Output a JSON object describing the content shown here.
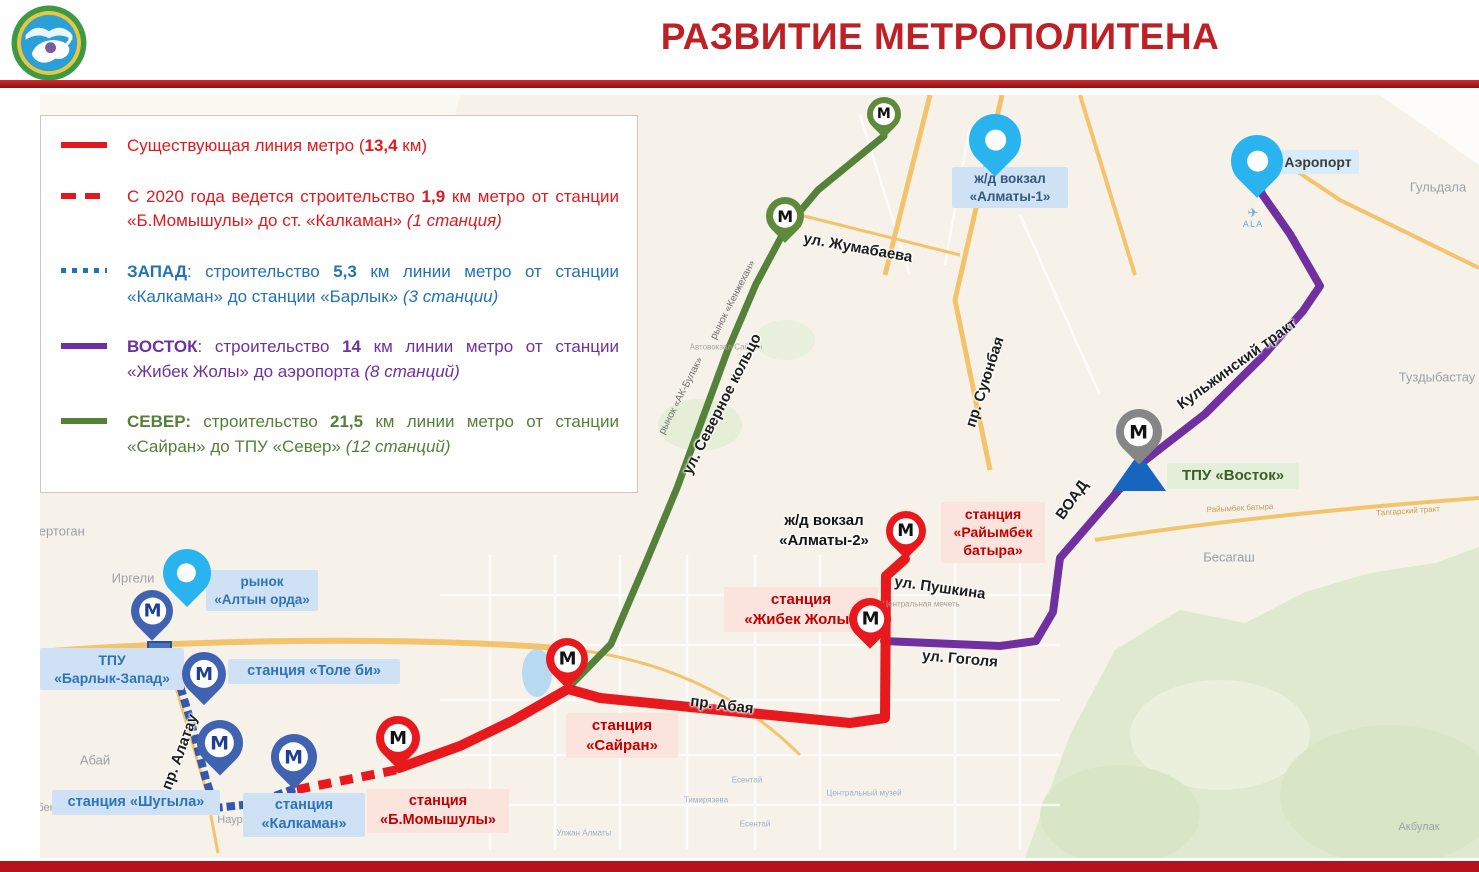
{
  "meta": {
    "width": 1479,
    "height": 872
  },
  "header": {
    "title": "РАЗВИТИЕ МЕТРОПОЛИТЕНА"
  },
  "palette": {
    "title_red": "#bf2025",
    "rule_red": "#a3141a",
    "footer_red": "#b5121b",
    "existing_red": "#e8191d",
    "west_blue": "#2e74b5",
    "east_purple": "#7030a0",
    "north_green": "#538135",
    "pink_box": "#fbe3de",
    "pink_text": "#c00000",
    "blue_box": "#cfe2f5",
    "blue_text": "#2e74b5",
    "green_box": "#e3efd9",
    "green_text": "#3a5f27",
    "cyan_pin": "#29b4ef",
    "blue_pin": "#3f63b0",
    "red_pin": "#e8191d",
    "green_pin": "#5d8a3b",
    "gray_pin": "#868686",
    "map_bg": "#f6f1e9"
  },
  "legend": {
    "items": [
      {
        "id": "existing",
        "swatch": "solid",
        "color": "#e2191c",
        "runs": [
          {
            "t": "Существующая линия метро (",
            "s": "n"
          },
          {
            "t": "13,4",
            "s": "b"
          },
          {
            "t": " км)",
            "s": "n"
          }
        ]
      },
      {
        "id": "construction-2020",
        "swatch": "dashed",
        "color": "#e2191c",
        "runs": [
          {
            "t": "С 2020 года ведется строительство ",
            "s": "n"
          },
          {
            "t": "1,9",
            "s": "b"
          },
          {
            "t": " км метро от станции «Б.Момышулы»  до ст. «Калкаман» ",
            "s": "n"
          },
          {
            "t": "(1 станция)",
            "s": "i"
          }
        ]
      },
      {
        "id": "west",
        "swatch": "dotted",
        "color": "#2272b8",
        "runs": [
          {
            "t": "ЗАПАД",
            "s": "b"
          },
          {
            "t": ": строительство ",
            "s": "n"
          },
          {
            "t": "5,3",
            "s": "b"
          },
          {
            "t": " км линии метро от станции «Калкаман» до станции «Барлык» ",
            "s": "n"
          },
          {
            "t": "(3 станции)",
            "s": "i"
          }
        ]
      },
      {
        "id": "east",
        "swatch": "solid",
        "color": "#7030a0",
        "runs": [
          {
            "t": "ВОСТОК",
            "s": "b"
          },
          {
            "t": ": строительство ",
            "s": "n"
          },
          {
            "t": "14",
            "s": "b"
          },
          {
            "t": " км линии метро от станции «Жибек Жолы» до аэропорта  ",
            "s": "n"
          },
          {
            "t": "(8 станций)",
            "s": "i"
          }
        ]
      },
      {
        "id": "north",
        "swatch": "solid",
        "color": "#538135",
        "runs": [
          {
            "t": "СЕВЕР:",
            "s": "b"
          },
          {
            "t": " строительство ",
            "s": "n"
          },
          {
            "t": "21,5",
            "s": "b"
          },
          {
            "t": " км линии метро от станции «Сайран» до ТПУ «Север» ",
            "s": "n"
          },
          {
            "t": "(12 станций)",
            "s": "i"
          }
        ]
      }
    ]
  },
  "map": {
    "airport_code": "ALA",
    "lines": [
      {
        "id": "north-line",
        "color": "#55823a",
        "width": 7,
        "cap": "round",
        "points": [
          [
            884,
            136
          ],
          [
            818,
            190
          ],
          [
            786,
            228
          ],
          [
            756,
            284
          ],
          [
            727,
            352
          ],
          [
            702,
            420
          ],
          [
            677,
            488
          ],
          [
            647,
            560
          ],
          [
            611,
            644
          ],
          [
            568,
            688
          ]
        ]
      },
      {
        "id": "east-line",
        "color": "#7030a0",
        "width": 8,
        "cap": "round",
        "points": [
          [
            884,
            641
          ],
          [
            1000,
            646
          ],
          [
            1036,
            641
          ],
          [
            1053,
            612
          ],
          [
            1060,
            558
          ],
          [
            1143,
            462
          ],
          [
            1205,
            414
          ],
          [
            1262,
            357
          ],
          [
            1303,
            311
          ],
          [
            1320,
            286
          ],
          [
            1290,
            234
          ],
          [
            1262,
            194
          ],
          [
            1256,
            179
          ]
        ]
      },
      {
        "id": "existing-line",
        "color": "#e8191d",
        "width": 10,
        "cap": "round",
        "points": [
          [
            905,
            559
          ],
          [
            886,
            576
          ],
          [
            885,
            718
          ],
          [
            850,
            723
          ],
          [
            700,
            708
          ],
          [
            600,
            698
          ],
          [
            568,
            689
          ],
          [
            512,
            721
          ],
          [
            460,
            746
          ],
          [
            424,
            759
          ],
          [
            399,
            768
          ]
        ]
      },
      {
        "id": "construction-2020-line",
        "color": "#e8191d",
        "width": 9,
        "dash": "13 9",
        "cap": "butt",
        "points": [
          [
            396,
            770
          ],
          [
            295,
            790
          ]
        ]
      },
      {
        "id": "west-line",
        "color": "#3558ae",
        "width": 8,
        "dash": "0.5 12",
        "cap": "square",
        "points": [
          [
            291,
            790
          ],
          [
            252,
            804
          ],
          [
            215,
            808
          ],
          [
            205,
            776
          ],
          [
            191,
            722
          ],
          [
            177,
            676
          ],
          [
            163,
            653
          ]
        ]
      }
    ],
    "station_labels": [
      {
        "id": "railway-almaty1",
        "style": "navy",
        "x": 952,
        "y": 167,
        "w": 104,
        "fs": 13.5,
        "lines": [
          "ж/д вокзал",
          "«Алматы-1»"
        ]
      },
      {
        "id": "airport",
        "style": "lightblue",
        "x": 1277,
        "y": 150,
        "w": 70,
        "fs": 14,
        "lines": [
          "Аэропорт"
        ]
      },
      {
        "id": "rynok-altyn-orda",
        "style": "blue",
        "x": 206,
        "y": 570,
        "w": 100,
        "fs": 13.5,
        "lines": [
          "рынок",
          "«Алтын орда»"
        ]
      },
      {
        "id": "tpu-barlyk-zapad",
        "style": "blue",
        "x": 40,
        "y": 648,
        "w": 132,
        "fs": 14,
        "lines": [
          "ТПУ",
          "«Барлык-Запад»"
        ]
      },
      {
        "id": "tole-bi",
        "style": "blue",
        "x": 228,
        "y": 659,
        "w": 160,
        "fs": 14.5,
        "lines": [
          "станция  «Толе би»"
        ]
      },
      {
        "id": "shugyla",
        "style": "blue",
        "x": 52,
        "y": 790,
        "w": 156,
        "fs": 14.5,
        "lines": [
          "станция  «Шугыла»"
        ]
      },
      {
        "id": "kalkaman",
        "style": "blue",
        "x": 243,
        "y": 793,
        "w": 110,
        "fs": 14.5,
        "lines": [
          "станция",
          "«Калкаман»"
        ]
      },
      {
        "id": "raiymbek-batyra",
        "style": "pink",
        "x": 941,
        "y": 502,
        "w": 92,
        "fs": 14,
        "lines": [
          "станция",
          "«Райымбек",
          "батыра»"
        ]
      },
      {
        "id": "zhibek-zholy",
        "style": "pink",
        "x": 724,
        "y": 587,
        "w": 142,
        "fs": 15,
        "lines": [
          "станция",
          "«Жибек Жолы»"
        ]
      },
      {
        "id": "sairan",
        "style": "pink",
        "x": 566,
        "y": 713,
        "w": 100,
        "fs": 15,
        "lines": [
          "станция",
          "«Сайран»"
        ]
      },
      {
        "id": "b-momyshuly",
        "style": "pink",
        "x": 367,
        "y": 789,
        "w": 130,
        "fs": 14.5,
        "lines": [
          "станция",
          "«Б.Момышулы»"
        ]
      },
      {
        "id": "tpu-vostok",
        "style": "green",
        "x": 1167,
        "y": 463,
        "w": 120,
        "fs": 15,
        "lines": [
          "ТПУ «Восток»"
        ]
      },
      {
        "id": "railway-almaty2",
        "style": "plain",
        "x": 770,
        "y": 508,
        "w": 96,
        "fs": 15,
        "lines": [
          "ж/д вокзал",
          "«Алматы-2»"
        ]
      }
    ],
    "street_labels": [
      {
        "text": "ул. Жумабаева",
        "x": 858,
        "y": 248,
        "rot": 10,
        "fs": 15
      },
      {
        "text": "ул. Пушкина",
        "x": 940,
        "y": 588,
        "rot": 8,
        "fs": 15
      },
      {
        "text": "ул. Гоголя",
        "x": 960,
        "y": 659,
        "rot": 5,
        "fs": 15
      },
      {
        "text": "пр. Абая",
        "x": 722,
        "y": 705,
        "rot": 7,
        "fs": 15
      },
      {
        "text": "пр. Суюнбая",
        "x": 985,
        "y": 382,
        "rot": -72,
        "fs": 15
      },
      {
        "text": "ул. Северное кольцо",
        "x": 722,
        "y": 404,
        "rot": -63,
        "fs": 15
      },
      {
        "text": "Кульжинский тракт",
        "x": 1237,
        "y": 364,
        "rot": -36,
        "fs": 15
      },
      {
        "text": "ВОАД",
        "x": 1072,
        "y": 500,
        "rot": -55,
        "fs": 15
      },
      {
        "text": "пр. Алатау",
        "x": 180,
        "y": 752,
        "rot": -70,
        "fs": 15
      },
      {
        "text": "рынок «Кенжехан»",
        "x": 733,
        "y": 300,
        "rot": -63,
        "fs": 10,
        "minor": true
      },
      {
        "text": "рынок «АК-Булак»",
        "x": 681,
        "y": 396,
        "rot": -63,
        "fs": 10,
        "minor": true
      }
    ],
    "place_labels": [
      {
        "text": "Кертоган",
        "x": 58,
        "y": 531,
        "fs": 13
      },
      {
        "text": "Иргели",
        "x": 133,
        "y": 578,
        "fs": 13
      },
      {
        "text": "Абай",
        "x": 95,
        "y": 760,
        "fs": 13
      },
      {
        "text": "Гульдала",
        "x": 1438,
        "y": 187,
        "fs": 13
      },
      {
        "text": "Туздыбастау",
        "x": 1437,
        "y": 377,
        "fs": 13
      },
      {
        "text": "Бесагаш",
        "x": 1229,
        "y": 557,
        "fs": 13
      },
      {
        "text": "Акбулак",
        "x": 1419,
        "y": 827,
        "fs": 11
      },
      {
        "text": "бек",
        "x": 46,
        "y": 808,
        "fs": 11
      },
      {
        "text": "Наур",
        "x": 230,
        "y": 820,
        "fs": 11
      }
    ],
    "small_labels": [
      {
        "text": "Автовокзал Сайран",
        "x": 726,
        "y": 347,
        "fs": 8,
        "c": "#a7a7a7"
      },
      {
        "text": "Центральная мечеть",
        "x": 921,
        "y": 604,
        "fs": 8,
        "c": "#a79f98"
      },
      {
        "text": "Тимирязева",
        "x": 706,
        "y": 800,
        "fs": 8,
        "c": "#9db0cf"
      },
      {
        "text": "Есентай",
        "x": 747,
        "y": 780,
        "fs": 8,
        "c": "#9db0cf"
      },
      {
        "text": "Есентай",
        "x": 755,
        "y": 824,
        "fs": 8,
        "c": "#9db0cf"
      },
      {
        "text": "Улжан Алматы",
        "x": 584,
        "y": 833,
        "fs": 8,
        "c": "#9db0cf"
      },
      {
        "text": "Центральный музей",
        "x": 864,
        "y": 793,
        "fs": 8,
        "c": "#9db0cf"
      },
      {
        "text": "Райымбек батыра",
        "x": 1240,
        "y": 508,
        "fs": 8,
        "c": "#cf9a52",
        "rot": -3
      },
      {
        "text": "Талгарский тракт",
        "x": 1408,
        "y": 511,
        "fs": 8,
        "c": "#cf9a52",
        "rot": -4
      }
    ],
    "pins": [
      {
        "id": "metro-sever-top",
        "kind": "metro",
        "color": "#5d8a3b",
        "lc": "#111111",
        "tip": [
          884,
          138
        ],
        "s": 34
      },
      {
        "id": "metro-sever-2",
        "kind": "metro",
        "color": "#5d8a3b",
        "lc": "#111111",
        "tip": [
          785,
          243
        ],
        "s": 38
      },
      {
        "id": "metro-raiymbek",
        "kind": "metro",
        "color": "#e8191d",
        "lc": "#111111",
        "tip": [
          906,
          559
        ],
        "s": 40
      },
      {
        "id": "metro-zhibek-zholy",
        "kind": "metro",
        "color": "#e8191d",
        "lc": "#111111",
        "tip": [
          870,
          649
        ],
        "s": 42
      },
      {
        "id": "metro-sairan",
        "kind": "metro",
        "color": "#e8191d",
        "lc": "#111111",
        "tip": [
          567,
          689
        ],
        "s": 42
      },
      {
        "id": "metro-momyshuly",
        "kind": "metro",
        "color": "#e8191d",
        "lc": "#111111",
        "tip": [
          398,
          769
        ],
        "s": 44
      },
      {
        "id": "metro-tpu-barlyk",
        "kind": "metro",
        "color": "#3f63b0",
        "lc": "#1f3f94",
        "tip": [
          152,
          641
        ],
        "s": 42
      },
      {
        "id": "metro-tole-bi",
        "kind": "metro",
        "color": "#3f63b0",
        "lc": "#1f3f94",
        "tip": [
          204,
          705
        ],
        "s": 44
      },
      {
        "id": "metro-shugyla",
        "kind": "metro",
        "color": "#3f63b0",
        "lc": "#1f3f94",
        "tip": [
          220,
          776
        ],
        "s": 46
      },
      {
        "id": "metro-kalkaman",
        "kind": "metro",
        "color": "#3f63b0",
        "lc": "#1f3f94",
        "tip": [
          294,
          790
        ],
        "s": 46
      },
      {
        "id": "metro-tpu-vostok",
        "kind": "metro",
        "color": "#868686",
        "lc": "#111111",
        "tip": [
          1139,
          465
        ],
        "s": 46
      },
      {
        "id": "poi-altyn-orda",
        "kind": "poi",
        "color": "#29b4ef",
        "tip": [
          187,
          607
        ],
        "s": 48
      },
      {
        "id": "poi-railway-almaty1",
        "kind": "poi",
        "color": "#29b4ef",
        "tip": [
          995,
          177
        ],
        "s": 52
      },
      {
        "id": "poi-airport",
        "kind": "poi",
        "color": "#29b4ef",
        "tip": [
          1257,
          198
        ],
        "s": 52
      }
    ]
  }
}
